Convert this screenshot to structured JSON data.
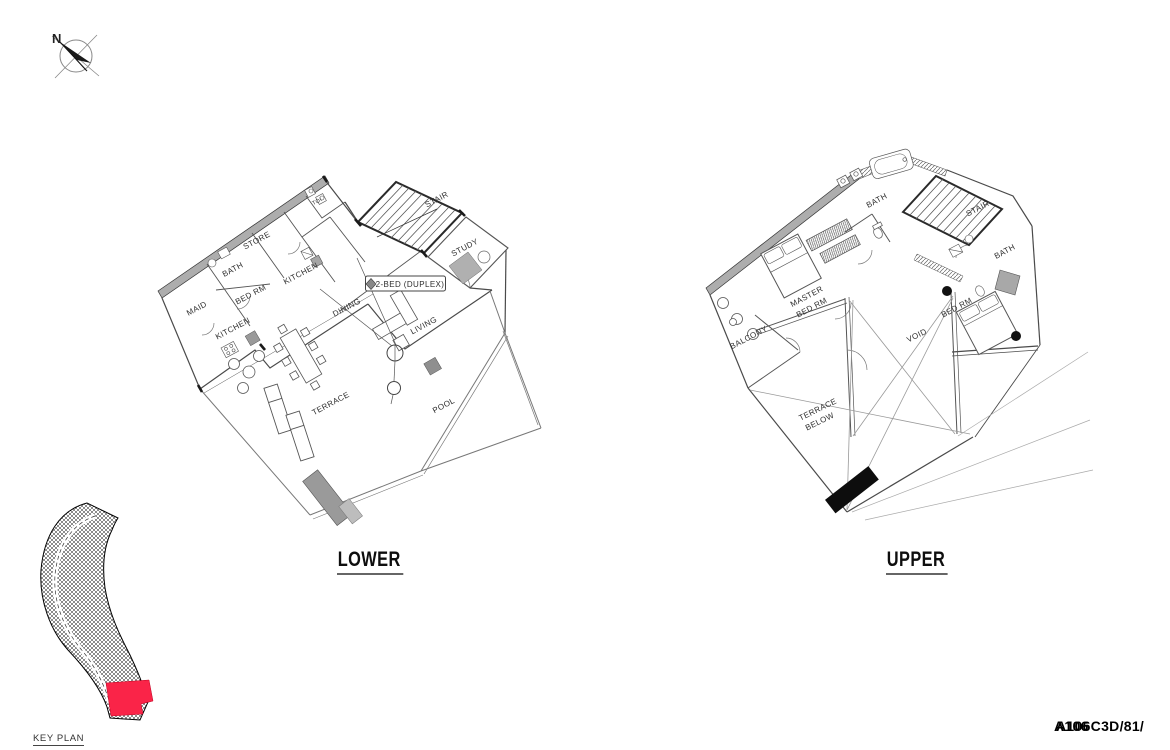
{
  "sheet": {
    "north_label": "N",
    "footer": {
      "ref": "A106C3D/81/",
      "ref_overlay": "A106"
    }
  },
  "lower_plan": {
    "title": "LOWER",
    "unit_tag": "2-BED (DUPLEX)",
    "rooms": {
      "maid": "MAID",
      "bath": "BATH",
      "bed_rm": "BED RM",
      "store": "STORE",
      "kitchen_upper": "KITCHEN",
      "kitchen_lower": "KITCHEN",
      "toi": "TOI",
      "dining": "DINING",
      "living": "LIVING",
      "stair": "STAIR",
      "study": "STUDY",
      "terrace": "TERRACE",
      "pool": "POOL"
    }
  },
  "upper_plan": {
    "title": "UPPER",
    "rooms": {
      "bath_top": "BATH",
      "stair": "STAIR",
      "bath_right": "BATH",
      "master_line1": "MASTER",
      "master_line2": "BED RM",
      "bed_rm": "BED RM",
      "balcony": "BALCONY",
      "void": "VOID",
      "terrace_below_line1": "TERRACE",
      "terrace_below_line2": "BELOW"
    }
  },
  "key_plan": {
    "label": "KEY PLAN",
    "highlight_color": "#fa2448"
  }
}
